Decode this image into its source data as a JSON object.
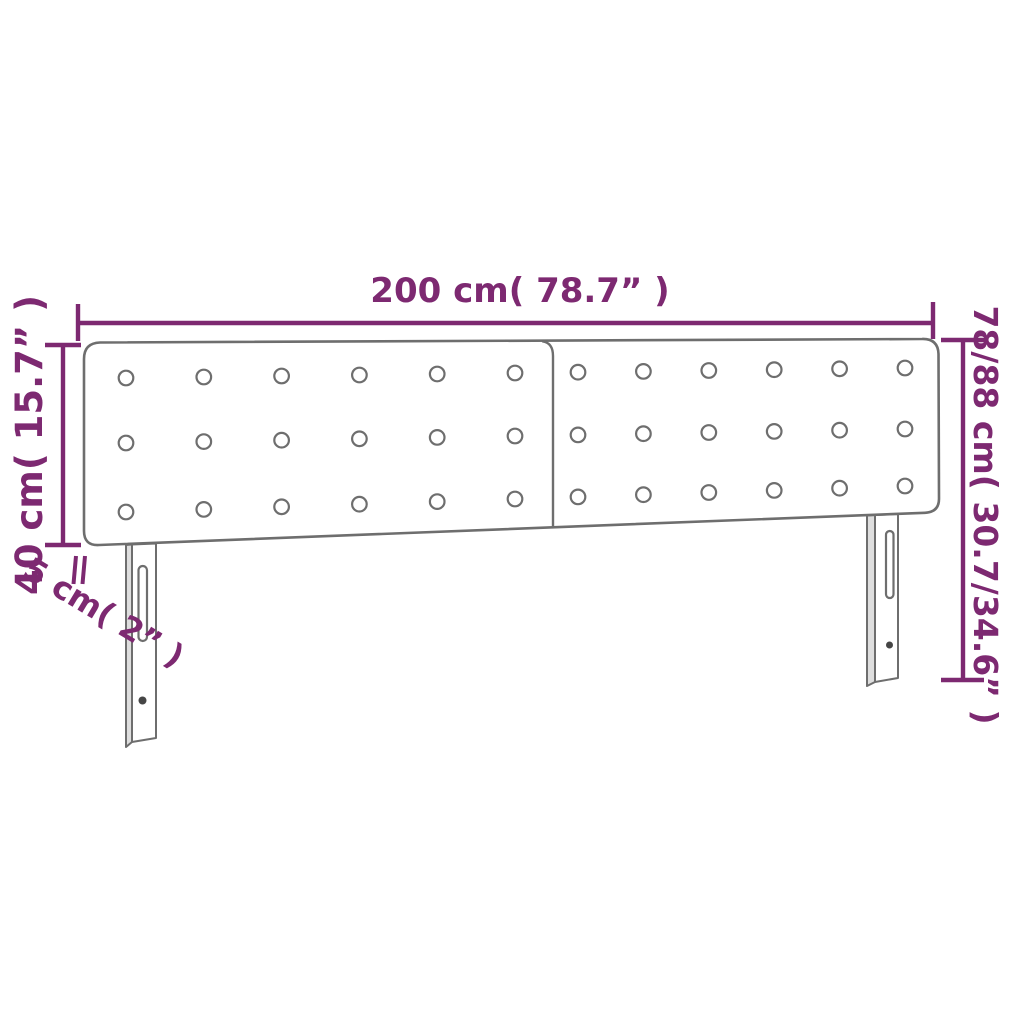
{
  "page": {
    "background": "#ffffff"
  },
  "diagram": {
    "kind": "product-dimension-diagram",
    "subject": "double-panel tufted headboard with two slotted legs",
    "colors": {
      "dimension_accent": "#7d2971",
      "outline_gray": "#6e6e6e",
      "side_face_gray": "#dedede",
      "screw_gray": "#454545",
      "background": "#ffffff"
    },
    "dimensions": {
      "width": {
        "label": "200 cm( 78.7” )"
      },
      "panel_height": {
        "label": "40 cm( 15.7” )"
      },
      "total_height": {
        "label": "78/88 cm( 30.7/34.6” )"
      },
      "thickness": {
        "label": "5 cm( 2” )"
      }
    },
    "tufting": {
      "rows": 3,
      "columns_per_panel": 6,
      "panels": 2,
      "total_buttons": 36
    }
  }
}
